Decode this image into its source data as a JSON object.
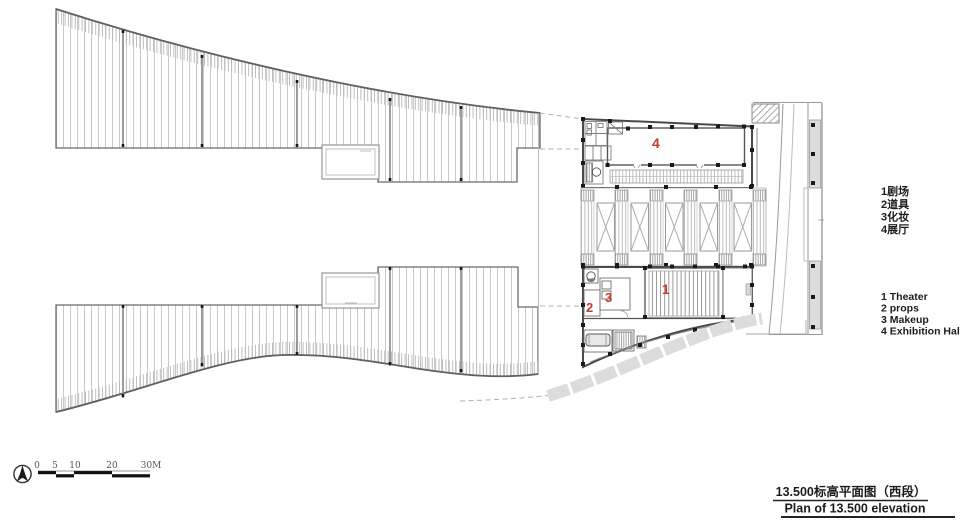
{
  "drawing": {
    "legend_cn": {
      "items": [
        "1剧场",
        "2道具",
        "3化妆",
        "4展厅"
      ]
    },
    "legend_en": {
      "items": [
        "1 Theater",
        "2 props",
        "3 Makeup",
        "4 Exhibition Hall"
      ]
    },
    "title_cn": "13.500标高平面图（西段）",
    "title_en": "Plan of 13.500 elevation",
    "scale_labels": [
      "0",
      "5",
      "10",
      "20",
      "30M"
    ],
    "room_labels": {
      "r1": "1",
      "r2": "2",
      "r3": "3",
      "r4": "4"
    },
    "colors": {
      "label_red": "#c5392f",
      "line_dark": "#4a4a4a",
      "hatch_light": "#c9c9c9",
      "fill_gray": "#dedede"
    }
  }
}
